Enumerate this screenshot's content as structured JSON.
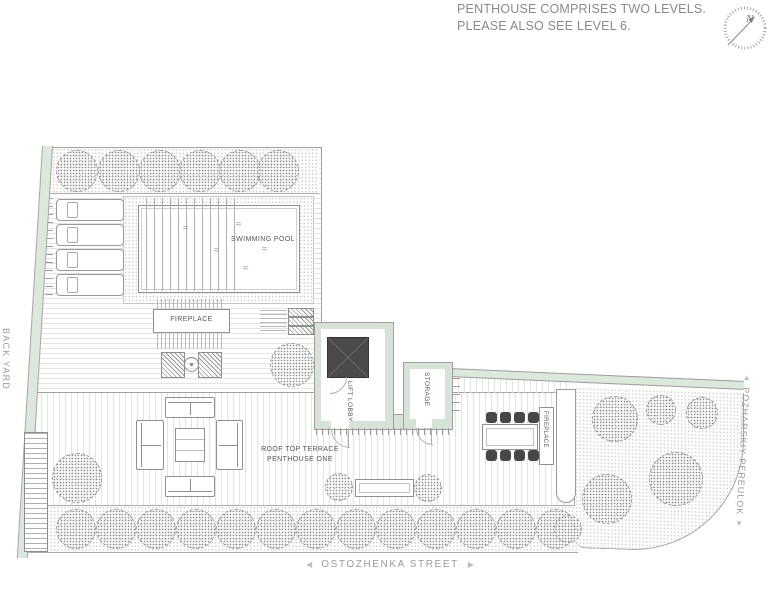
{
  "note": {
    "line1": "PENTHOUSE COMPRISES TWO LEVELS.",
    "line2": "PLEASE ALSO SEE LEVEL 6."
  },
  "compass": {
    "north": "N"
  },
  "plan": {
    "swimming_pool": "SWIMMING POOL",
    "fireplace_lounge": "FIREPLACE",
    "lift_lobby": "LIFT LOBBY",
    "storage": "STORAGE",
    "terrace_line1": "ROOF TOP TERRACE",
    "terrace_line2": "PENTHOUSE ONE",
    "fireplace_dining": "FIREPLACE"
  },
  "streets": {
    "back_yard": "BACK YARD",
    "ostozhenka": "OSTOZHENKA STREET",
    "pozharskiy": "POZHARSKIY PEREULOK"
  },
  "icons": {
    "street_left": "◀",
    "street_right": "▶",
    "street_up": "▲",
    "street_down": "▼",
    "water": "≈"
  },
  "colors": {
    "landscape_green": "#dde8dd",
    "wall_green": "#d7e3d7",
    "line_gray": "#9e9e9e",
    "label_text": "#555555",
    "note_text": "#8a8a8a",
    "street_text": "#9b9b9b",
    "lift_dark": "#4a4a4a",
    "chair_dark": "#474747"
  }
}
